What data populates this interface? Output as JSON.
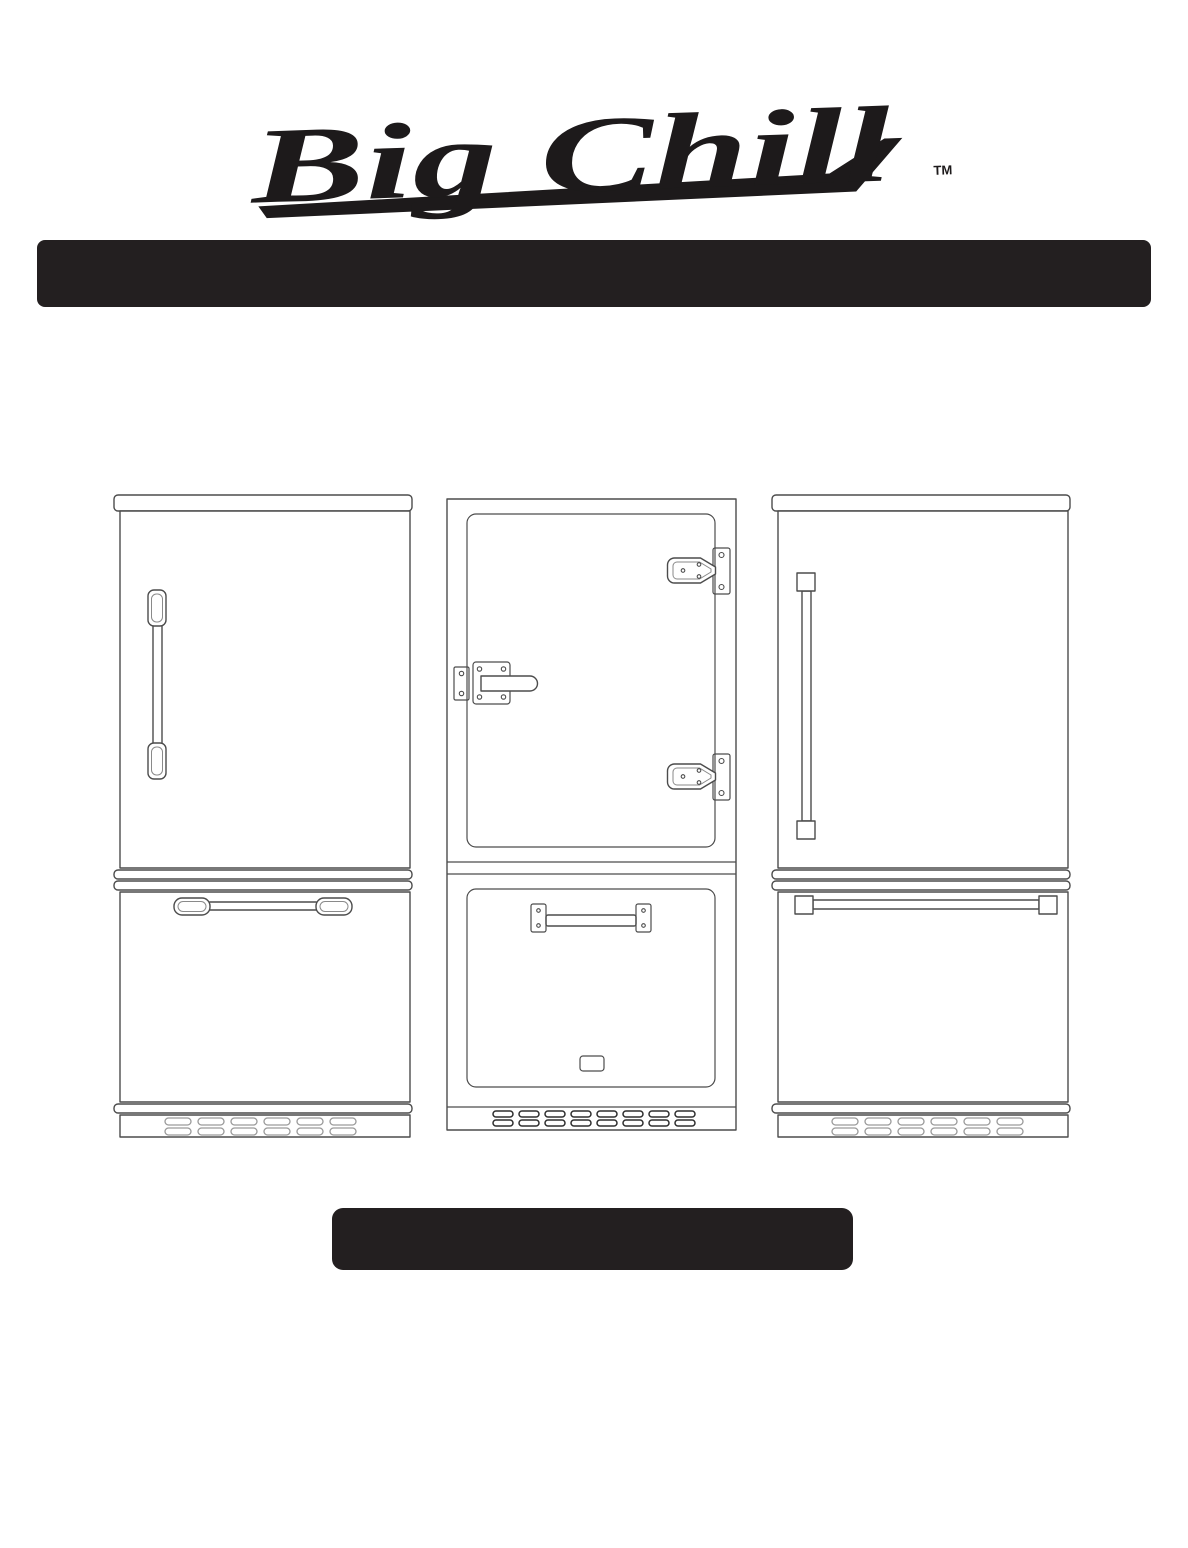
{
  "page": {
    "background": "#ffffff"
  },
  "logo": {
    "text": "Big Chill",
    "trademark": "TM",
    "color": "#1d1a1b"
  },
  "banners": {
    "top_bar_color": "#231f20",
    "bottom_bar_color": "#231f20"
  },
  "illustrations": {
    "left": {
      "name": "bottom-freezer-fridge-retro-chrome-handles-icon"
    },
    "middle": {
      "name": "bottom-freezer-fridge-original-latch-and-hinges-icon"
    },
    "right": {
      "name": "bottom-freezer-fridge-pro-bar-handles-icon"
    }
  }
}
